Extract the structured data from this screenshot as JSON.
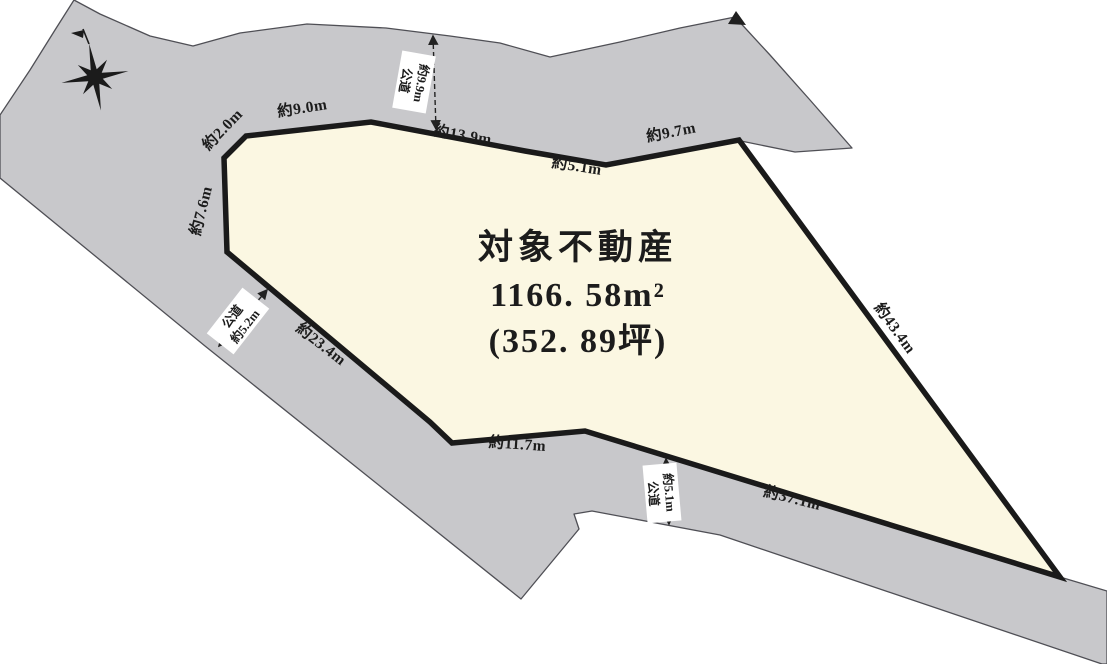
{
  "parcel": {
    "title": "対象不動産",
    "area_m2": "1166. 58m²",
    "area_tsubo": "(352. 89坪)"
  },
  "edge_labels": {
    "e20": "約2.0m",
    "e90": "約9.0m",
    "e139": "約13.9m",
    "e51": "約5.1m",
    "e97": "約9.7m",
    "e434": "約43.4m",
    "e76": "約7.6m",
    "e234": "約23.4m",
    "e117": "約11.7m",
    "e371": "約37.1m"
  },
  "road_labels": {
    "top": {
      "type": "公道",
      "width": "約9.9m"
    },
    "left": {
      "type": "公道",
      "width": "約5.2m"
    },
    "bottom": {
      "type": "公道",
      "width": "約5.1m"
    }
  },
  "colors": {
    "road_fill": "#c8c8cb",
    "parcel_fill": "#fbf7e2",
    "boundary": "#1a1a1a",
    "thin_line": "#4f4f55"
  }
}
